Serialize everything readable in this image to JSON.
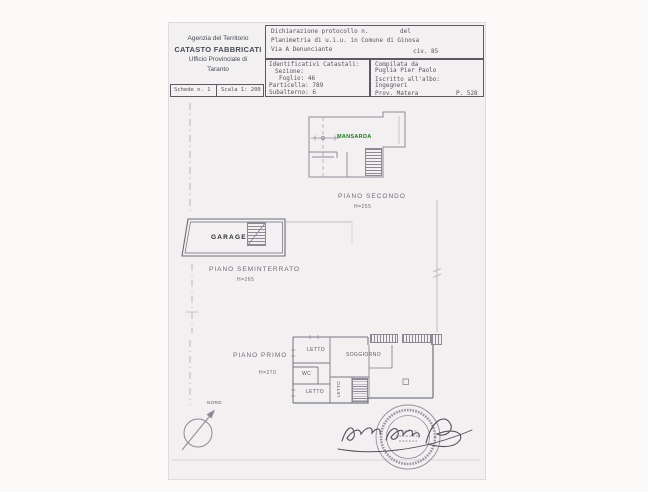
{
  "document": {
    "agency": {
      "line1": "Agenzia del Territorio",
      "line2": "CATASTO FABBRICATI",
      "line3": "Ufficio Provinciale di",
      "line4": "Taranto"
    },
    "sheet_info": {
      "schede": "Schede n. 1",
      "scala": "Scala 1: 200"
    },
    "declaration": {
      "protocol": "Dichiarazione protocollo n.",
      "del": "del",
      "planimetria": "Planimetria di u.i.u. in Comune di Ginosa",
      "via": "Via A Denunciante",
      "civ": "civ. 85"
    },
    "catasto_ids": {
      "title": "Identificativi Catastali:",
      "sezione": "Sezione:",
      "foglio": "Foglio: 46",
      "particella": "Particella: 789",
      "subalterno": "Subalterno: 6"
    },
    "compiler": {
      "compilata": "Compilata da",
      "nome": "Puglia Pier Paolo",
      "iscritto": "Iscritto all'albo:",
      "albo": "Ingegneri",
      "prov": "Prov. Matera",
      "num": "P. 528"
    }
  },
  "plan": {
    "mansarda_label": "MANSARDA",
    "piano_secondo": "PIANO SECONDO",
    "piano_secondo_h": "H=255",
    "garage_label": "GARAGE",
    "piano_seminterrato": "PIANO SEMINTERRATO",
    "piano_seminterrato_h": "H=265",
    "piano_primo": "PIANO PRIMO",
    "piano_primo_h": "H=270",
    "rooms": {
      "letto_top": "LETTO",
      "wc": "WC",
      "letto_bottom": "LETTO",
      "soggiorno": "SOGGIORNO",
      "letto_vertical": "LETTO"
    },
    "compass_label": "NORD"
  },
  "colors": {
    "mansarda_green": "#1d7c1d",
    "ink": "#57535f",
    "wall_gray": "#847f8e",
    "sheet_bg": "#f2f0f1"
  }
}
